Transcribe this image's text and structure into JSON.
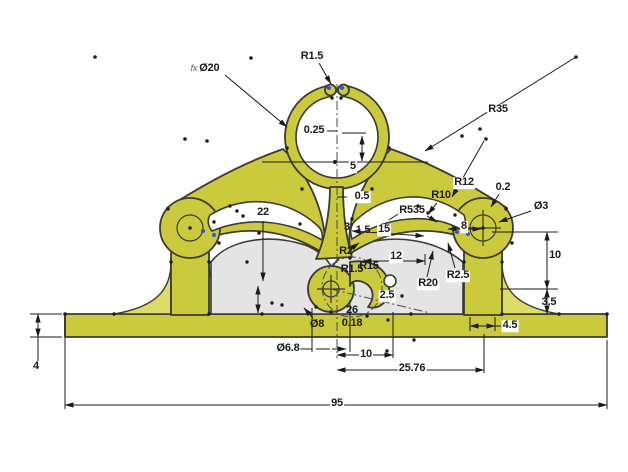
{
  "colors": {
    "background": "#ffffff",
    "part_fill": "#cbc93c",
    "part_light": "#dcdc6b",
    "web_fill": "#e4e4e4",
    "outline": "#3b3b33",
    "dimension": "#1b1b1b",
    "construction": "#4a4a4a",
    "point_blue": "#2857e0"
  },
  "dimensions": [
    {
      "id": "d20",
      "prefix": "fx",
      "text": "Ø20",
      "x": 205,
      "y": 69,
      "masked": true
    },
    {
      "id": "r15top",
      "text": "R1.5",
      "x": 312,
      "y": 57,
      "masked": true
    },
    {
      "id": "r35",
      "text": "R35",
      "x": 498,
      "y": 110,
      "masked": true
    },
    {
      "id": "d025",
      "text": "0.25",
      "x": 314,
      "y": 131,
      "masked": true
    },
    {
      "id": "d5c",
      "text": "5",
      "x": 353,
      "y": 167,
      "masked": true
    },
    {
      "id": "d05",
      "text": "0.5",
      "x": 362,
      "y": 197,
      "masked": true
    },
    {
      "id": "d22",
      "text": "22",
      "x": 263,
      "y": 213,
      "masked": true
    },
    {
      "id": "r12",
      "text": "R12",
      "x": 464,
      "y": 183,
      "masked": true
    },
    {
      "id": "r10",
      "text": "R10",
      "x": 441,
      "y": 196,
      "masked": false
    },
    {
      "id": "d02",
      "text": "0.2",
      "x": 503,
      "y": 188,
      "masked": true
    },
    {
      "id": "dia3",
      "text": "Ø3",
      "x": 541,
      "y": 207,
      "masked": true
    },
    {
      "id": "r535",
      "text": "R535",
      "x": 412,
      "y": 211,
      "masked": false
    },
    {
      "id": "d3",
      "text": "3",
      "x": 347,
      "y": 228,
      "masked": false
    },
    {
      "id": "d15s",
      "text": "1.5",
      "x": 363,
      "y": 231,
      "masked": false
    },
    {
      "id": "d15",
      "text": "15",
      "x": 384,
      "y": 230,
      "masked": true
    },
    {
      "id": "d8gap",
      "text": "8",
      "x": 464,
      "y": 227,
      "masked": true
    },
    {
      "id": "r2",
      "text": "R2",
      "x": 346,
      "y": 252,
      "masked": false
    },
    {
      "id": "d12",
      "text": "12",
      "x": 396,
      "y": 257,
      "masked": true
    },
    {
      "id": "r15b",
      "text": "R1.5",
      "x": 352,
      "y": 270,
      "masked": false
    },
    {
      "id": "r15c",
      "text": "R15",
      "x": 369,
      "y": 267,
      "masked": false
    },
    {
      "id": "r25",
      "text": "R2.5",
      "x": 458,
      "y": 276,
      "masked": true
    },
    {
      "id": "r20",
      "text": "R20",
      "x": 428,
      "y": 284,
      "masked": true
    },
    {
      "id": "d25",
      "text": "2.5",
      "x": 387,
      "y": 296,
      "masked": true
    },
    {
      "id": "d26",
      "text": "26",
      "x": 352,
      "y": 311,
      "masked": false
    },
    {
      "id": "d018",
      "text": "0.18",
      "x": 352,
      "y": 324,
      "masked": false
    },
    {
      "id": "dia8",
      "text": "Ø8",
      "x": 317,
      "y": 325,
      "masked": false
    },
    {
      "id": "d10r",
      "text": "10",
      "x": 555,
      "y": 256,
      "masked": true
    },
    {
      "id": "d35",
      "text": "3.5",
      "x": 549,
      "y": 303,
      "masked": false
    },
    {
      "id": "d45",
      "text": "4.5",
      "x": 510,
      "y": 326,
      "masked": true
    },
    {
      "id": "dia68",
      "text": "Ø6.8",
      "x": 288,
      "y": 349,
      "masked": true
    },
    {
      "id": "d10b",
      "text": "10",
      "x": 366,
      "y": 355,
      "masked": true
    },
    {
      "id": "d2576",
      "text": "25.76",
      "x": 412,
      "y": 369,
      "masked": true
    },
    {
      "id": "d95",
      "text": "95",
      "x": 337,
      "y": 404,
      "masked": true
    },
    {
      "id": "d4",
      "text": "4",
      "x": 36,
      "y": 367,
      "masked": true
    }
  ]
}
